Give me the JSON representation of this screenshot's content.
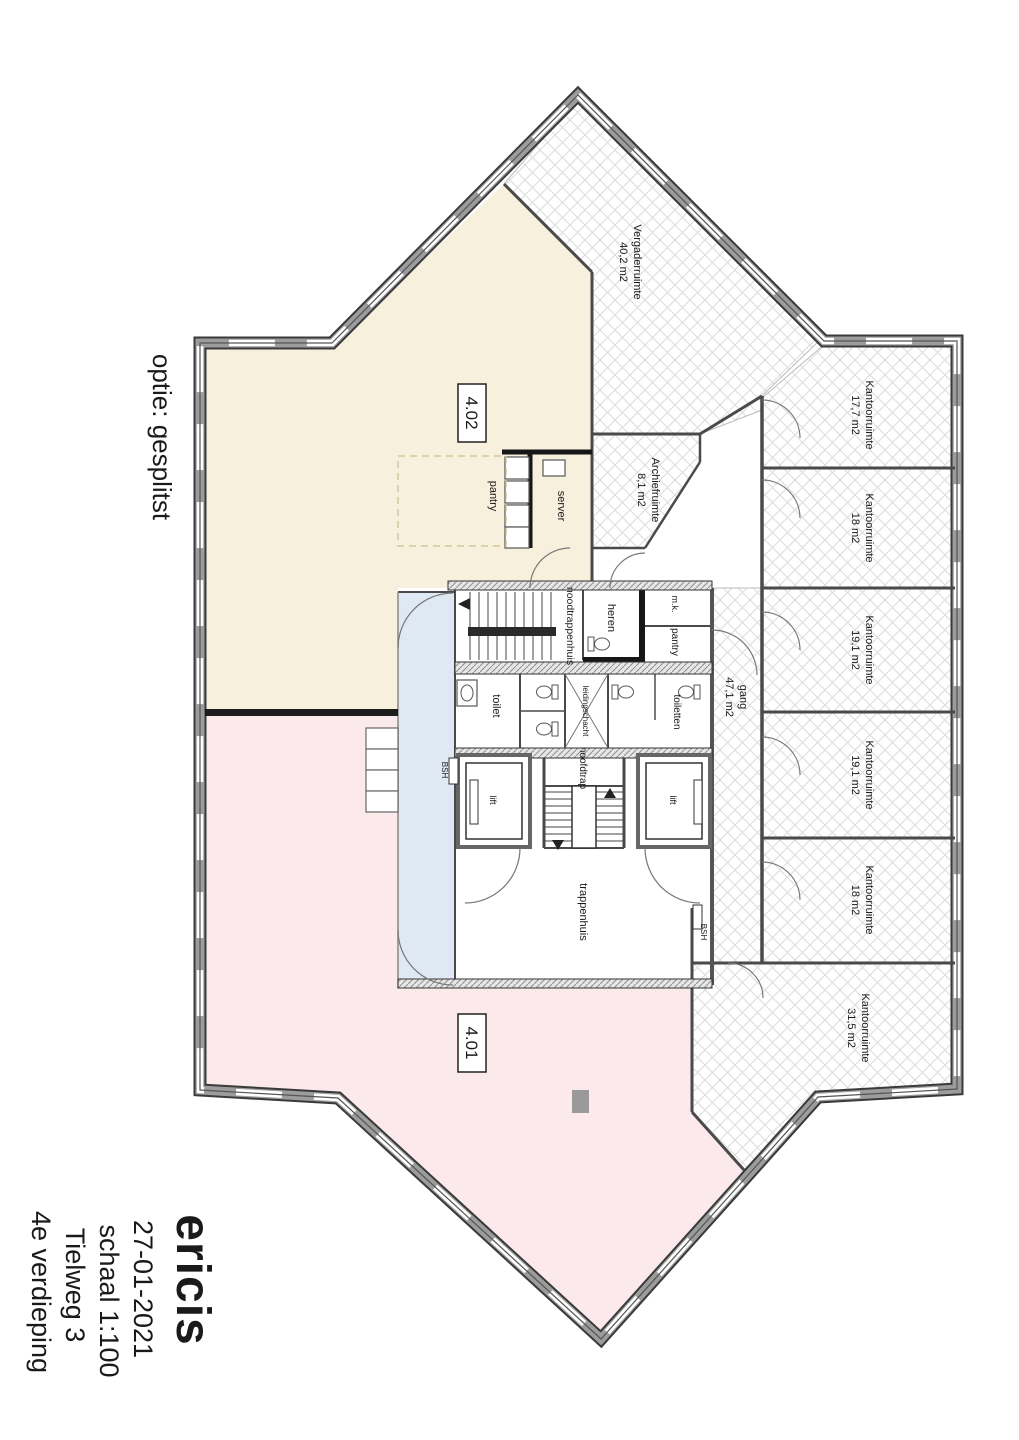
{
  "annotation": {
    "option_label": "optie: gesplitst"
  },
  "title_block": {
    "logo": "ericis",
    "date": "27-01-2021",
    "scale": "schaal 1:100",
    "address": "Tielweg 3",
    "floor": "4e verdieping"
  },
  "units": {
    "unit_a": "4.02",
    "unit_b": "4.01"
  },
  "rooms": {
    "vergaderruimte": {
      "name": "Vergaderruimte",
      "area": "40,2 m2"
    },
    "archiefruimte": {
      "name": "Archiefruimte",
      "area": "8,1 m2"
    },
    "kantoor_1": {
      "name": "Kantoorruimte",
      "area": "17,7 m2"
    },
    "kantoor_2": {
      "name": "Kantoorruimte",
      "area": "18 m2"
    },
    "kantoor_3": {
      "name": "Kantoorruimte",
      "area": "19,1 m2"
    },
    "kantoor_4": {
      "name": "Kantoorruimte",
      "area": "19,1 m2"
    },
    "kantoor_5": {
      "name": "Kantoorruimte",
      "area": "18 m2"
    },
    "kantoor_6": {
      "name": "Kantoorruimte",
      "area": "31,5 m2"
    },
    "gang": {
      "name": "gang",
      "area": "47,1 m2"
    }
  },
  "core": {
    "noodtrappenhuis": "noodtrappenhuis",
    "heren": "heren",
    "meterkast": "m.k.",
    "pantry_small": "pantry",
    "toilet": "toilet",
    "leidingschacht": "leidingschacht",
    "toiletten": "toiletten",
    "lift_left": "lift",
    "lift_right": "lift",
    "hoofdtrap": "hoofdtrap",
    "trappenhuis": "trappenhuis",
    "bsh_left": "BSH",
    "bsh_right": "BSH",
    "pantry": "pantry",
    "server": "server"
  },
  "colors": {
    "logo": "#3cb5ce",
    "unit_a_fill": "#f7f0dd",
    "unit_b_fill": "#fbe9eb",
    "circulation_fill": "#dfe9f4",
    "wall_gray": "#9c9c9c",
    "wall_dark": "#3a3a3a"
  }
}
